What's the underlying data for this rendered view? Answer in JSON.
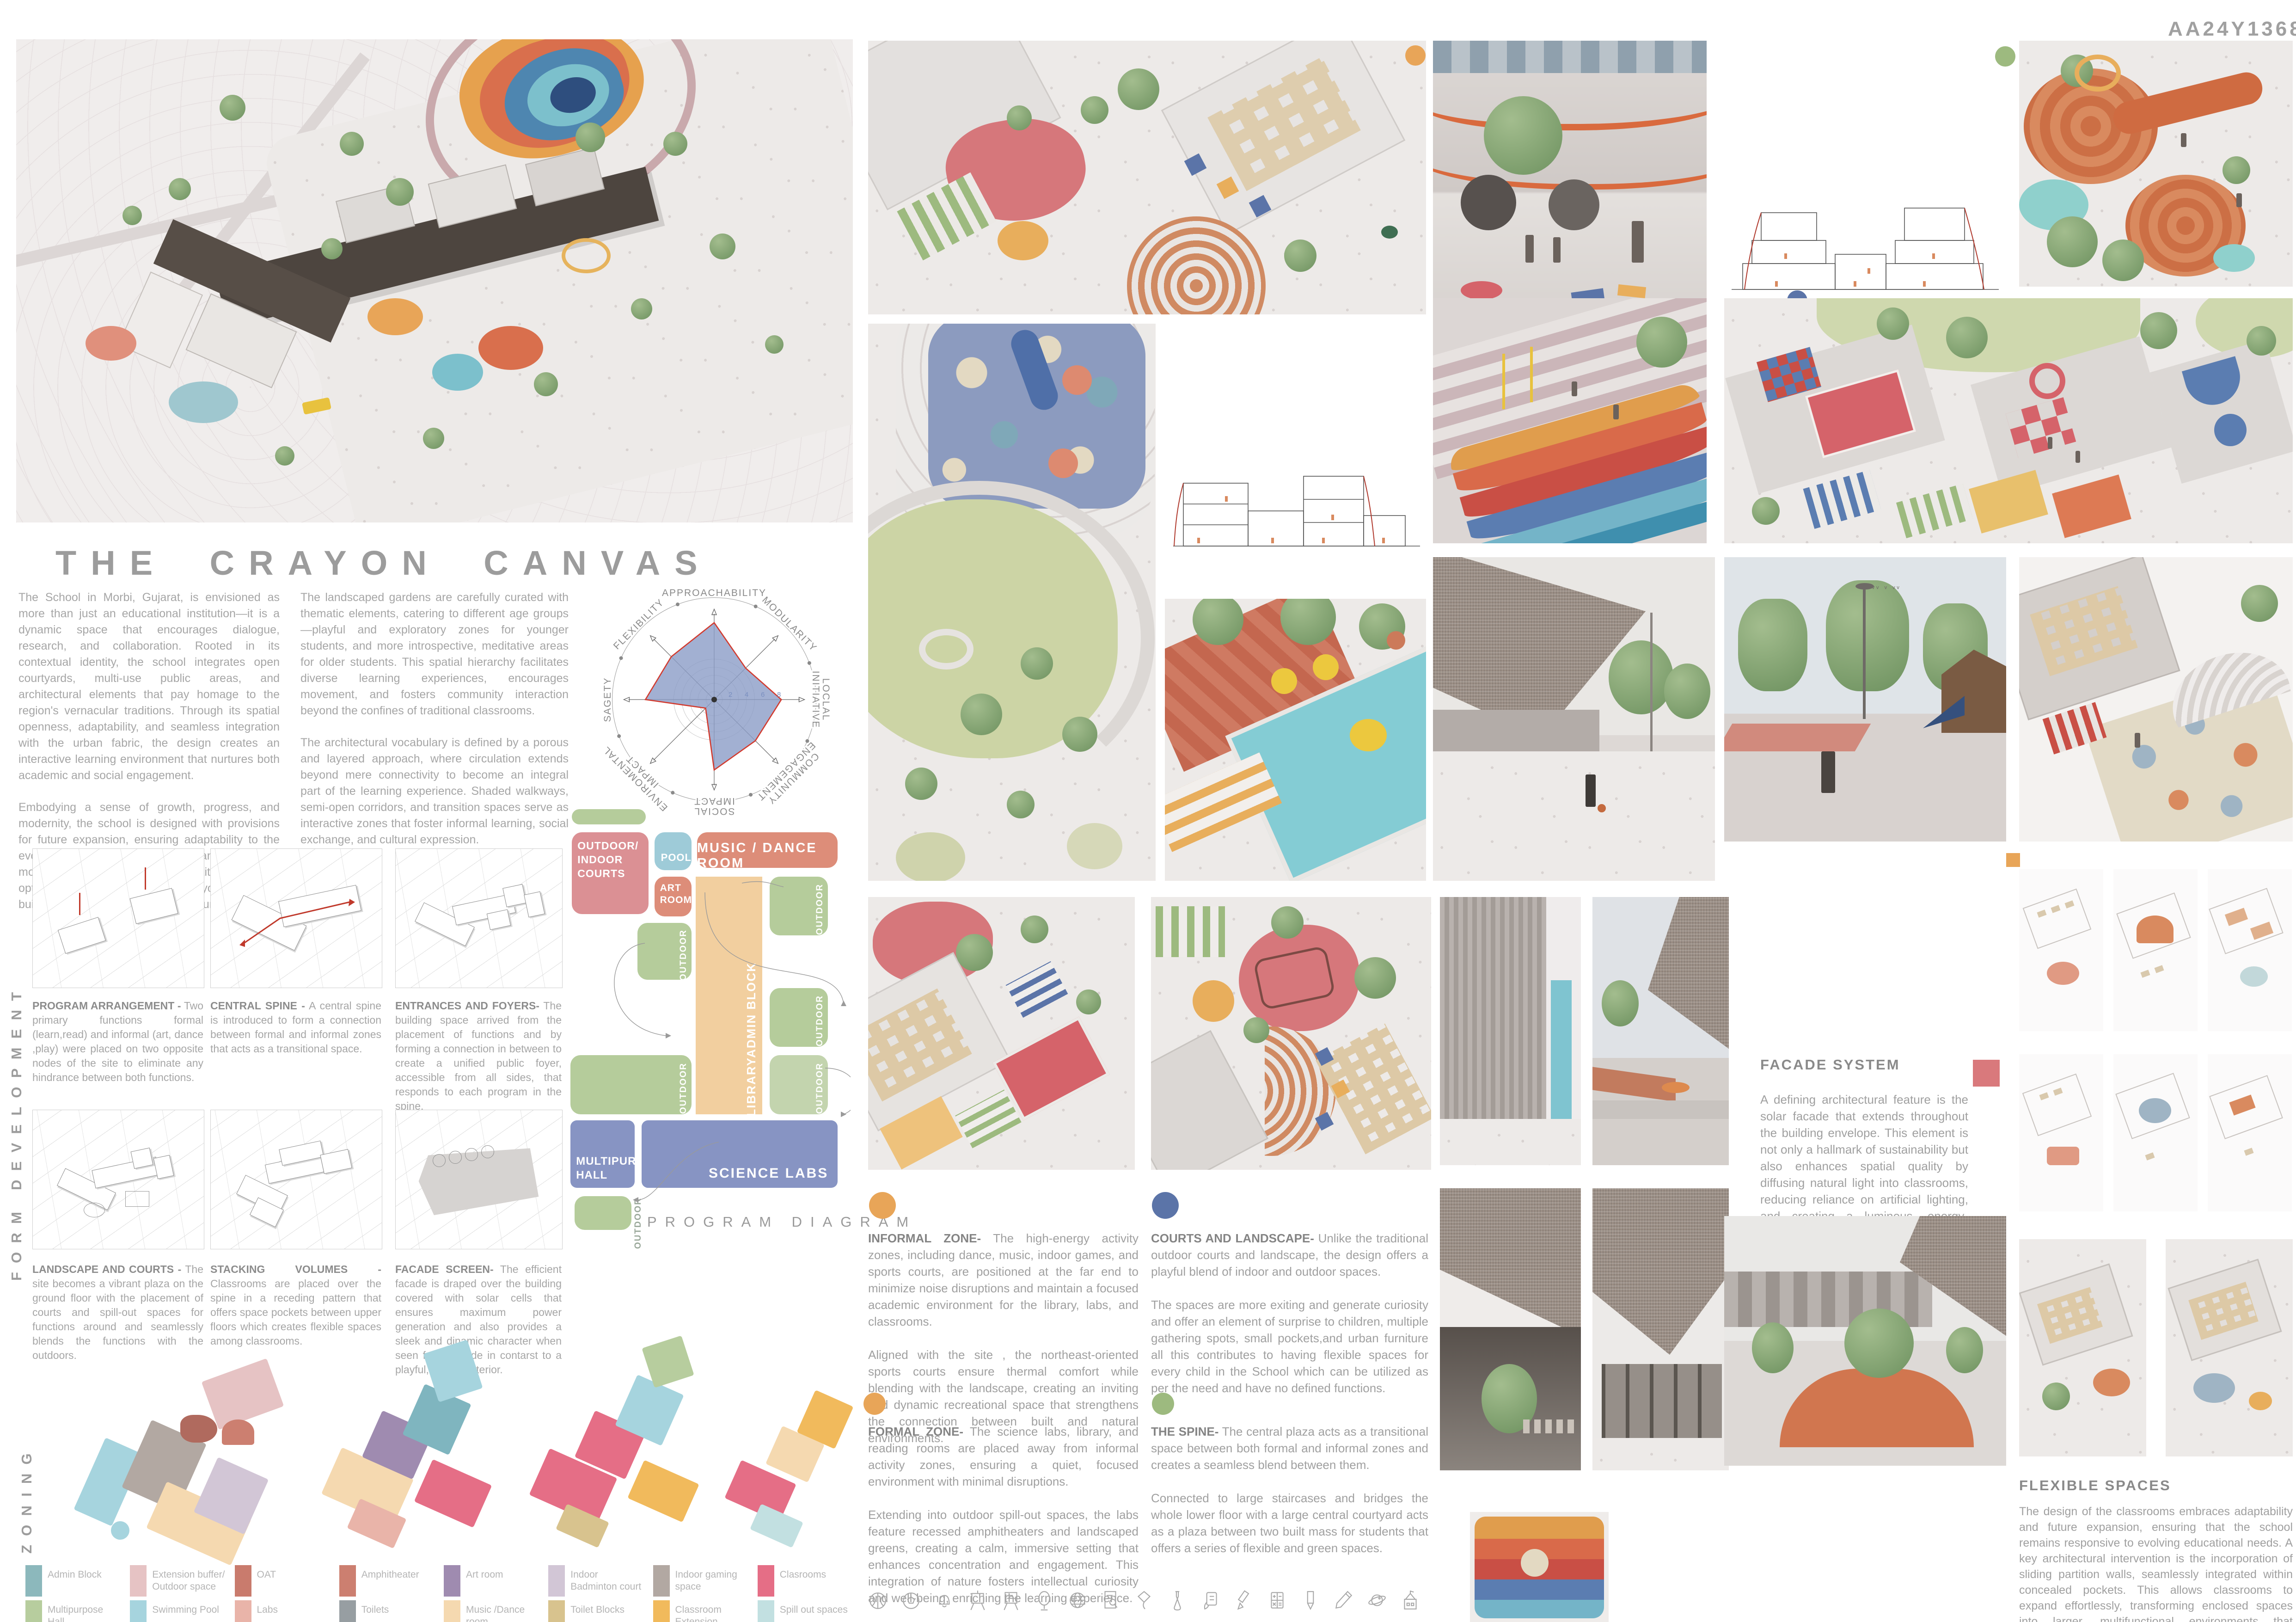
{
  "board": {
    "code": "AA24Y1368"
  },
  "title": "THE CRAYON CANVAS",
  "intro": {
    "col1_p1": "The School in Morbi, Gujarat, is envisioned as more than just an educational institution—it is a dynamic space that encourages dialogue, research, and collaboration. Rooted in its contextual identity, the school integrates open courtyards, multi-use public areas, and architectural elements that pay homage to the region's vernacular traditions. Through its spatial openness, adaptability, and seamless integration with the urban fabric, the design creates an interactive learning environment that nurtures both academic and social engagement.",
    "col1_p2": "Embodying a sense of growth, progress, and modernity, the school is designed with provisions for future expansion, ensuring adaptability to the evolving needs of education. The planning strategy moves away from a monolithic institutional block, opting instead for a decentralized layout of multiple buildings interconnected by open courtyards..",
    "col2_p1": "The landscaped gardens are carefully curated with thematic elements, catering to different age groups—playful and exploratory zones for younger students, and more introspective, meditative areas for older students. This spatial hierarchy facilitates diverse learning experiences, encourages movement, and fosters community interaction beyond the confines of traditional classrooms.",
    "col2_p2": "The architectural vocabulary is defined by a porous and layered approach, where circulation extends beyond mere connectivity to become an integral part of the learning experience. Shaded walkways, semi-open corridors, and transition spaces serve as interactive zones that foster informal learning, social exchange, and cultural expression."
  },
  "chart_data": {
    "type": "radar",
    "axes": [
      "APPROACHABILITY",
      "MODULARITY",
      "LOCLAL INITIATIVE",
      "COMMUNITY ENGAGEMENT",
      "SOCIAL IMPACT",
      "ENVIROMENTAL IMPACT",
      "SAGETY",
      "FLEXIBILITY"
    ],
    "values": [
      9.5,
      5.5,
      8.3,
      7.2,
      8.7,
      1.5,
      8.5,
      7.5
    ],
    "ticks": [
      2,
      4,
      6,
      8
    ],
    "max": 10,
    "fill": "#8b9cc7",
    "stroke": "#d23b2f",
    "grid": "circular",
    "legend_position": "none",
    "title": ""
  },
  "form_development": {
    "label": "FORM DEVELOPMENT",
    "panels": [
      {
        "title": "PROGRAM ARRANGEMENT -",
        "text": "Two primary functions formal (learn,read) and informal (art, dance ,play) were placed on two opposite nodes of the site to eliminate any hindrance between both functions."
      },
      {
        "title": "CENTRAL SPINE -",
        "text": "A central spine is introduced to form a connection between formal and informal zones that acts as a transitional space."
      },
      {
        "title": "ENTRANCES AND FOYERS-",
        "text": "The building space arrived from the placement of functions and by forming a connection in between to create a unified public foyer, accessible from all sides, that responds to each program in the spine."
      },
      {
        "title": "LANDSCAPE AND COURTS -",
        "text": "The site becomes a vibrant plaza on the ground floor with the placement of courts and spill-out spaces for functions around and seamlessly blends the functions with the outdoors."
      },
      {
        "title": "STACKING VOLUMES -",
        "text": "Classrooms are placed over the spine in a receding pattern that offers space pockets between upper floors which creates flexible spaces among classrooms."
      },
      {
        "title": "FACADE SCREEN-",
        "text": "The efficient facade is draped over the building covered with solar cells that ensures maximum power generation and also provides a sleek and dinamic character when seen form outside in contarst to a playful, inviting interior."
      }
    ]
  },
  "program_diagram": {
    "label": "PROGRAM DIAGRAM",
    "blocks": {
      "courts": "OUTDOOR/ INDOOR COURTS",
      "pool": "POOL",
      "music": "MUSIC / DANCE ROOM",
      "art": "ART ROOM",
      "admin": "ADMIN BLOCK",
      "library": "LIBRARY",
      "multipurpose": "MULTIPURPOSE HALL",
      "science": "SCIENCE LABS",
      "outdoor": "OUTDOOR"
    }
  },
  "zoning": {
    "label": "ZONING"
  },
  "legend": {
    "items": [
      {
        "label": "Admin Block",
        "color": "#8cb8bc"
      },
      {
        "label": "Extension buffer/ Outdoor space",
        "color": "#e6c3c4"
      },
      {
        "label": "OAT",
        "color": "#c97b6d"
      },
      {
        "label": "Amphitheater",
        "color": "#cc7f70"
      },
      {
        "label": "Art room",
        "color": "#9f8bb0"
      },
      {
        "label": "Indoor Badminton court",
        "color": "#d2c6d6"
      },
      {
        "label": "Indoor gaming space",
        "color": "#b2a8a2"
      },
      {
        "label": "Clasrooms",
        "color": "#e56e86"
      },
      {
        "label": "Multipurpose Hall",
        "color": "#b7cd9e"
      },
      {
        "label": "Swimming Pool",
        "color": "#a6d4de"
      },
      {
        "label": "Labs",
        "color": "#e9b4a9"
      },
      {
        "label": "Toilets",
        "color": "#979ea2"
      },
      {
        "label": "Music /Dance room",
        "color": "#f5d9b0"
      },
      {
        "label": "Toilet Blocks",
        "color": "#d8c38e"
      },
      {
        "label": "Classroom Extension",
        "color": "#f1ba5c"
      },
      {
        "label": "Spill out spaces",
        "color": "#c2e0e1"
      }
    ]
  },
  "zones": [
    {
      "heading": "INFORMAL ZONE-",
      "dot": "#e8a558",
      "p1": "The high-energy activity zones, including dance, music, indoor games, and sports courts, are positioned at the far end to minimize noise disruptions and maintain a focused academic environment for the library, labs, and classrooms.",
      "p2": "Aligned with the site , the northeast-oriented sports courts ensure thermal comfort while blending with the landscape, creating an inviting and dynamic recreational space that strengthens the connection between built and natural environments."
    },
    {
      "heading": "COURTS AND LANDSCAPE-",
      "dot": "#5b74a8",
      "p1": "Unlike the traditional outdoor courts and landscape, the design offers a playful blend of indoor and outdoor spaces.",
      "p2": "The spaces are more exiting and generate curiosity and offer an element of surprise to children, multiple gathering spots, small pockets,and  urban furniture all this contributes to having flexible spaces for every child in the School which can be utilized as per the need and have no defined functions."
    },
    {
      "heading": "FORMAL ZONE-",
      "dot": "#e8a558",
      "p1": "The science labs, library, and reading rooms are placed away from informal activity zones, ensuring a quiet, focused environment with minimal disruptions.",
      "p2": "Extending into outdoor spill-out spaces, the labs feature recessed amphitheaters and landscaped greens, creating a calm, immersive setting that enhances concentration and engagement. This integration of nature fosters intellectual curiosity and well-being, enriching the learning experience."
    },
    {
      "heading": "THE SPINE-",
      "dot": "#9dba7f",
      "p1": "The central plaza acts as a transitional space between both formal and informal zones and creates a seamless blend between them.",
      "p2": "Connected to large staircases and bridges the whole lower floor with a large central courtyard acts as a plaza between two built mass for students that offers a series of flexible and green spaces."
    }
  ],
  "facade_system": {
    "heading": "FACADE SYSTEM",
    "text": "A defining architectural feature is the solar facade that extends throughout the building envelope. This element is not only a hallmark of sustainability but also enhances spatial quality by diffusing natural light into classrooms, reducing reliance on artificial lighting, and creating a luminous, energy-efficient learning atmosphere."
  },
  "flexible_spaces": {
    "heading": "FLEXIBLE SPACES",
    "text": "The design of the classrooms embraces adaptability and future expansion, ensuring that the school remains responsive to evolving educational needs. A key architectural intervention is the incorporation of sliding partition walls, seamlessly integrated within concealed pockets. This allows classrooms to expand effortlessly, transforming enclosed spaces into larger, multifunctional environments that accommodate diverse academic and extracurricular activities"
  },
  "accents": {
    "orange": "#e8a558",
    "blue": "#5b74a8",
    "green": "#9dba7f",
    "red_square": "#d9797c",
    "spine_tan": "#f2cf9f",
    "diagram_green": "#b5cc9b",
    "diagram_pink": "#db9094",
    "diagram_salmon": "#dd8d79",
    "diagram_blue": "#8794c3",
    "diagram_pool": "#9ecbd8"
  },
  "icon_row": [
    "basketball",
    "football",
    "bell",
    "easel",
    "noticeboard",
    "mirror",
    "globe",
    "report",
    "kite",
    "flask",
    "chat-note",
    "marker",
    "calculator",
    "pencil",
    "pencil-tilt",
    "planet",
    "school"
  ]
}
